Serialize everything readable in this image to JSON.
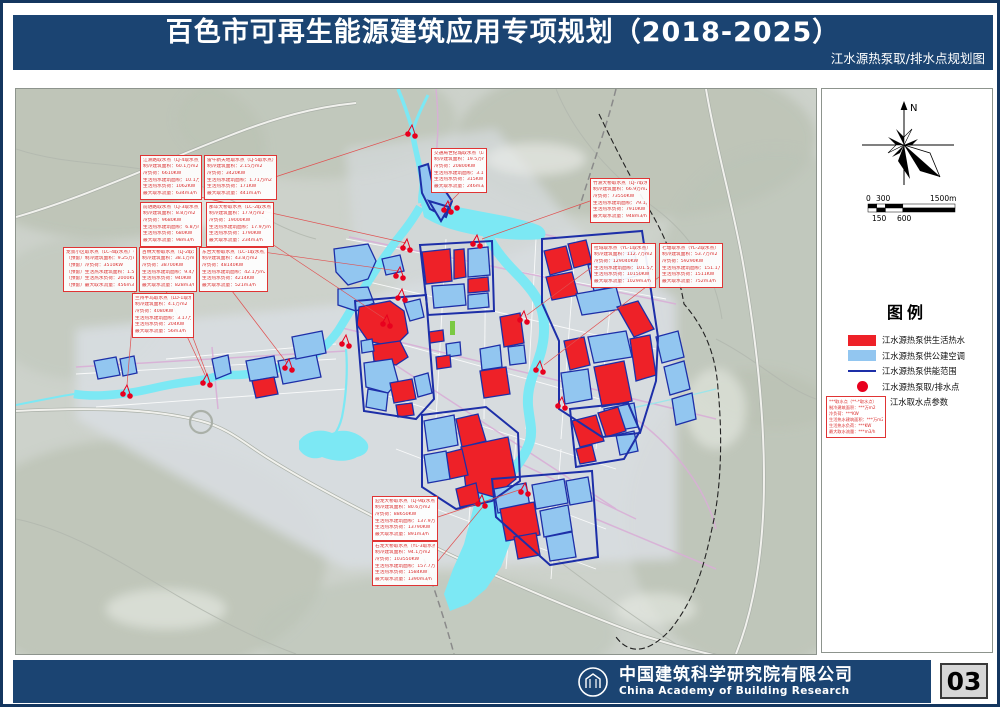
{
  "header": {
    "title": "百色市可再生能源建筑应用专项规划（2018-2025）",
    "subtitle": "江水源热泵取/排水点规划图"
  },
  "map": {
    "annotations": [
      {
        "x": 124,
        "y": 66,
        "w": 62,
        "title": "江洲路取水点（LJ-4取水点）",
        "lines": [
          "制冷建筑面积：60.1万m2",
          "冷负荷：6610KW",
          "生活热水建筑面积：10.1万m2",
          "生活热水负荷：1062KW",
          "最大取水流量：634m3/h"
        ]
      },
      {
        "x": 188,
        "y": 66,
        "w": 73,
        "title": "雷午新天地取水点（LJ-5取水点）",
        "lines": [
          "制冷建筑面积：2.15万m2",
          "冷负荷：3420KW",
          "生活热水建筑面积：1.71万m2",
          "生活热水负荷：171KW",
          "最大取水流量：441m3/h"
        ]
      },
      {
        "x": 124,
        "y": 113,
        "w": 62,
        "title": "前进路取水点（LJ-3取水点）",
        "lines": [
          "制冷建筑面积：8.8万m2",
          "冷负荷：9680KW",
          "生活热水建筑面积：6.8万m2",
          "生活热水负荷：680KW",
          "最大取水流量：98m3/h"
        ]
      },
      {
        "x": 190,
        "y": 113,
        "w": 68,
        "title": "那毕大桥取水点（LC-2取水点）",
        "lines": [
          "制冷建筑面积：17.9万m2",
          "冷负荷：19000KW",
          "生活热水建筑面积：17.9万m2",
          "生活热水负荷：1790KW",
          "最大取水流量：234m3/h"
        ]
      },
      {
        "x": 47,
        "y": 158,
        "w": 74,
        "title": "龙景小区取水点（LC-4取水点）（预留）",
        "lines": [
          "（预留）制冷建筑面积：9.25万m2",
          "（预留）冷负荷：3510KW",
          "（预留）生活热水建筑面积：1.5万m2",
          "（预留）生活热水负荷：2000KW",
          "（预留）最大取水流量：456m3/h"
        ]
      },
      {
        "x": 123,
        "y": 158,
        "w": 58,
        "title": "百林大桥取水点（LJ-2取水点）",
        "lines": [
          "制冷建筑面积：38.1万m2",
          "冷负荷：38700KW",
          "生活热水建筑面积：9.4万m2",
          "生活热水负荷：940KW",
          "最大取水流量：828m3/h"
        ]
      },
      {
        "x": 183,
        "y": 158,
        "w": 69,
        "title": "东合大桥取水点（LC-1取水点）",
        "lines": [
          "制冷建筑面积：43.8万m2",
          "冷负荷：48140KW",
          "生活热水建筑面积：42.1万m2",
          "生活热水负荷：4214KW",
          "最大取水流量：521m3/h"
        ]
      },
      {
        "x": 116,
        "y": 204,
        "w": 62,
        "title": "兰州半岛取水点（LD-1取水点）",
        "lines": [
          "制冷建筑面积：4.1万m2",
          "冷负荷：4080KW",
          "生活热水建筑面积：3.17万m2",
          "生活热水负荷：204KW",
          "最大取水流量：56m3/h"
        ]
      },
      {
        "x": 415,
        "y": 59,
        "w": 56,
        "title": "交通局世纪城取水点（LC-3取水点）",
        "lines": [
          "制冷建筑面积：19.5万m2",
          "冷负荷：20800KW",
          "生活热水建筑面积：3.15万m2",
          "生活热水负荷：315KW",
          "最大取水流量：246m3/h"
        ]
      },
      {
        "x": 574,
        "y": 89,
        "w": 60,
        "title": "竹洲大桥取水点（LJ-7取水点）",
        "lines": [
          "制冷建筑面积：66.9万m2",
          "冷负荷：73550KW",
          "生活热水建筑面积：79.1万m2",
          "生活热水负荷：7910KW",
          "最大取水流量：948m3/h"
        ]
      },
      {
        "x": 575,
        "y": 154,
        "w": 65,
        "title": "拉域取水点（YL-1取水点）",
        "lines": [
          "制冷建筑面积：112.7万m2",
          "冷负荷：129040KW",
          "生活热水建筑面积：101.5万m2",
          "生活热水负荷：10150KW",
          "最大取水流量：1029m3/h"
        ]
      },
      {
        "x": 643,
        "y": 154,
        "w": 64,
        "title": "七塘取水点（YL-2取水点）",
        "lines": [
          "制冷建筑面积：53.7万m2",
          "冷负荷：59290KW",
          "生活热水建筑面积：151.1万m2",
          "生活热水负荷：1511KW",
          "最大取水流量：752m3/h"
        ]
      },
      {
        "x": 356,
        "y": 407,
        "w": 66,
        "title": "迎龙大桥取水点（LJ-9取水点）",
        "lines": [
          "制冷建筑面积：80.6万m2",
          "冷负荷：88650KW",
          "生活热水建筑面积：137.9万m2",
          "生活热水负荷：13790KW",
          "最大取水流量：891m3/h"
        ]
      },
      {
        "x": 356,
        "y": 452,
        "w": 66,
        "title": "石龙大桥取水点（YL-3取水点）",
        "lines": [
          "制冷建筑面积：94.1万m2",
          "冷负荷：103550KW",
          "生活热水建筑面积：157.7万m2",
          "生活热水负荷：1584KW",
          "最大取水流量：1390m3/h"
        ]
      }
    ],
    "intake_points": [
      {
        "x": 396,
        "y": 42,
        "n": 2
      },
      {
        "x": 432,
        "y": 118,
        "n": 3
      },
      {
        "x": 461,
        "y": 152,
        "n": 2
      },
      {
        "x": 391,
        "y": 156,
        "n": 2
      },
      {
        "x": 384,
        "y": 184,
        "n": 2
      },
      {
        "x": 386,
        "y": 206,
        "n": 2
      },
      {
        "x": 371,
        "y": 232,
        "n": 2
      },
      {
        "x": 330,
        "y": 252,
        "n": 2
      },
      {
        "x": 508,
        "y": 228,
        "n": 2
      },
      {
        "x": 524,
        "y": 278,
        "n": 2
      },
      {
        "x": 546,
        "y": 314,
        "n": 2
      },
      {
        "x": 273,
        "y": 276,
        "n": 2
      },
      {
        "x": 191,
        "y": 291,
        "n": 2
      },
      {
        "x": 111,
        "y": 302,
        "n": 2
      },
      {
        "x": 509,
        "y": 400,
        "n": 2
      },
      {
        "x": 466,
        "y": 412,
        "n": 2
      }
    ],
    "leader_lines": [
      [
        184,
        108,
        390,
        154
      ],
      [
        259,
        88,
        394,
        44
      ],
      [
        190,
        155,
        382,
        182
      ],
      [
        256,
        155,
        369,
        230
      ],
      [
        119,
        202,
        111,
        296
      ],
      [
        150,
        202,
        189,
        286
      ],
      [
        216,
        202,
        271,
        274
      ],
      [
        176,
        246,
        191,
        286
      ],
      [
        443,
        104,
        433,
        114
      ],
      [
        574,
        112,
        466,
        150
      ],
      [
        576,
        178,
        511,
        226
      ],
      [
        643,
        188,
        528,
        276
      ],
      [
        422,
        428,
        506,
        400
      ],
      [
        422,
        472,
        470,
        414
      ]
    ]
  },
  "side_panel": {
    "north_label": "N",
    "scale": {
      "zero": "0",
      "mid": "300",
      "end": "1500m",
      "b1": "150",
      "b2": "600"
    },
    "legend": {
      "title": "图例",
      "items": [
        {
          "swatch": "red",
          "label": "江水源热泵供生活热水"
        },
        {
          "swatch": "blue",
          "label": "江水源热泵供公建空调"
        },
        {
          "swatch": "line",
          "label": "江水源热泵供能范围"
        },
        {
          "swatch": "circle",
          "label": "江水源热泵取/排水点"
        },
        {
          "swatch": "sample",
          "label": "江水取水点参数"
        }
      ],
      "sample_box_lines": [
        "***取水点（**-*取水点）",
        "制冷建筑面积：***万m2",
        "冷负荷：***KW",
        "生活热水建筑面积：***万m2",
        "生活热水负荷：***KW",
        "最大取水流量：***m3/h"
      ]
    }
  },
  "footer": {
    "org_cn": "中国建筑科学研究院有限公司",
    "org_en": "China Academy of Building Research",
    "page_number": "03"
  },
  "colors": {
    "header_bg": "#1b4472",
    "parcel_hot_water": "#ee2128",
    "parcel_public_ac": "#92c6f0",
    "supply_outline": "#1d2fa8",
    "intake_point": "#e8001e",
    "river": "#7ce8f4",
    "annotation": "#d92c2c"
  }
}
